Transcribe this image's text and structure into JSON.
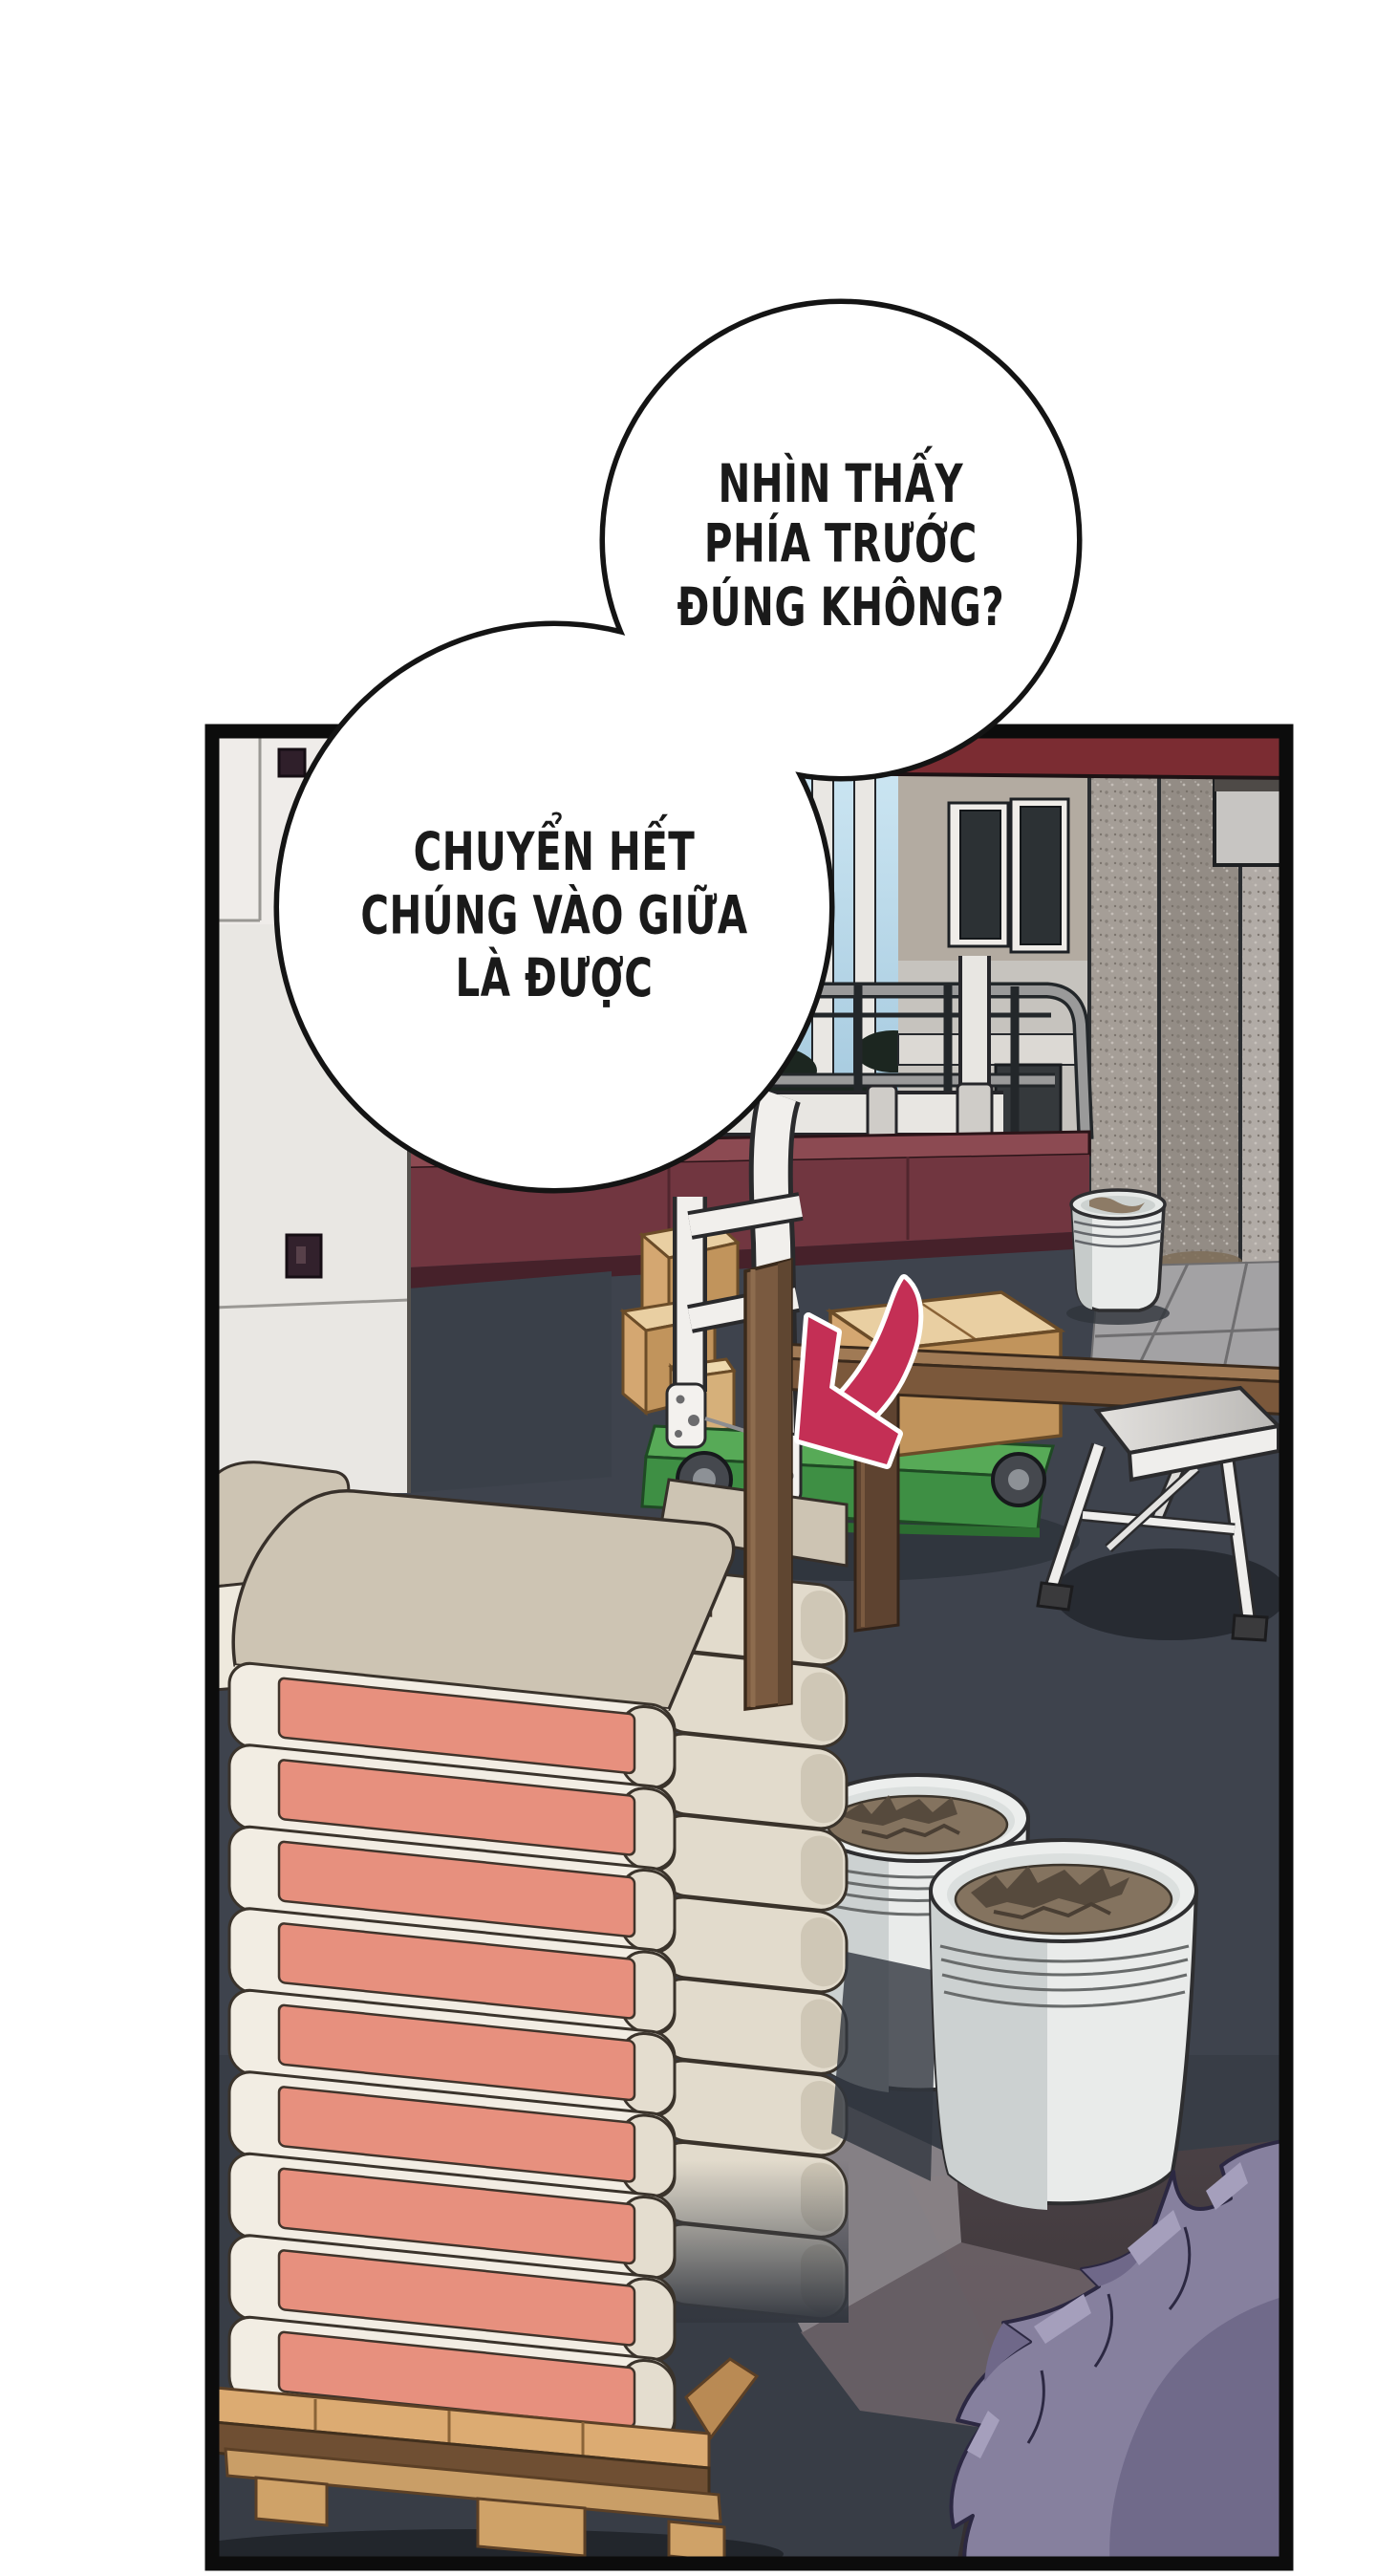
{
  "comic_page": {
    "type": "webtoon-panel",
    "speech_bubbles": [
      {
        "name": "bubble-top",
        "lines": [
          "NHÌN THẤY",
          "PHÍA TRƯỚC",
          "ĐÚNG KHÔNG?"
        ]
      },
      {
        "name": "bubble-bottom",
        "lines": [
          "CHUYỂN HẾT",
          "CHÚNG VÀO GIỮA",
          "LÀ ĐƯỢC"
        ]
      }
    ],
    "palette": {
      "page_bg": "#ffffff",
      "panel_border": "#0c0c0c",
      "bubble_fill": "#ffffff",
      "bubble_stroke": "#141414",
      "text_color": "#1a1a1a",
      "floor": "#3e434d",
      "floor_front": "#383d46",
      "left_wall": "#e9e7e3",
      "maroon_wall": "#713640",
      "maroon_ledge": "#8c4a52",
      "maroon_trim": "#46212a",
      "awning_red": "#7b2c32",
      "sky_top": "#cfe8f4",
      "sky_bottom": "#9cc3da",
      "building_wall": "#b3aba1",
      "building_lower": "#c6c3be",
      "window_glass": "#2c3134",
      "concrete_left": "#a59e97",
      "concrete_right": "#938c85",
      "path_concrete": "#a3a2a4",
      "railing_gray": "#9a9a9a",
      "pipe_white": "#e8e6e2",
      "cart_green_top": "#57aa57",
      "cart_green_front": "#3e8f44",
      "handle_white": "#f1efec",
      "box_tan_top": "#e9cfa2",
      "box_tan_front": "#d4a771",
      "box_tan_side": "#c1945c",
      "wood_post": "#7a5a40",
      "wood_beam_top": "#a07a55",
      "wood_beam_front": "#7b583b",
      "wood_dark_post": "#5e4330",
      "arrow_red": "#c42f55",
      "bag_face": "#f2ede3",
      "bag_top": "#cdc4b3",
      "bag_label": "#e7907e",
      "bag_cap": "#e4ddcf",
      "bag_cap_back": "#e2dbcc",
      "pallet_top": "#dcab72",
      "pallet_dark": "#6f4f33",
      "pallet_bottom": "#c99e67",
      "bucket_body": "#e9ebea",
      "bucket_rim": "#dbdfde",
      "bucket_contents": "#84735f",
      "stool_white": "#efeeec",
      "hair_mid": "#86809e",
      "hair_dark": "#6f6889",
      "hair_light": "#a59fbc",
      "hair_outline": "#2c2842",
      "char_backdrop": "#4a4145"
    },
    "stacks": {
      "front_bag_count": 9,
      "back_cap_count": 9
    }
  }
}
